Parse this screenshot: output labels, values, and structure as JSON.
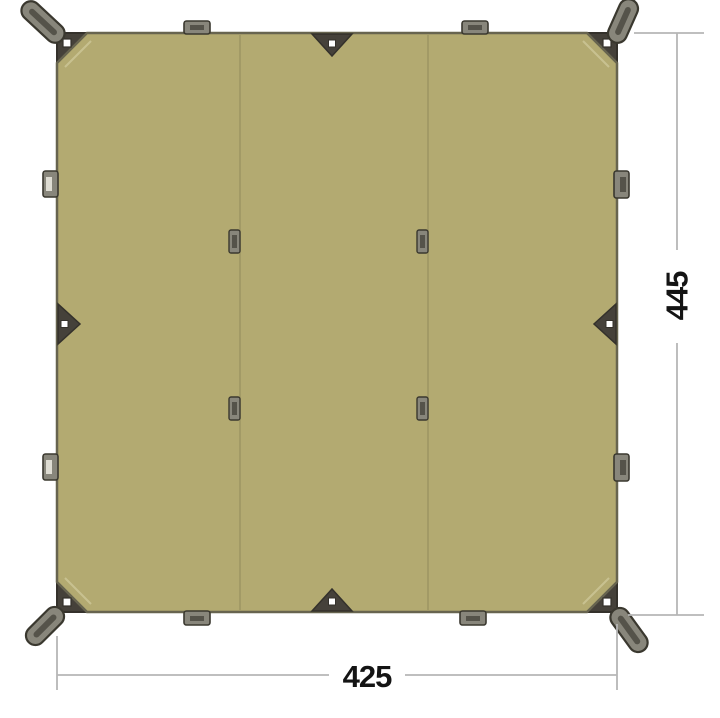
{
  "diagram": {
    "kind": "product-dimension-diagram",
    "subject": "rectangular-tarp-top-view",
    "dimension_labels": {
      "width": "425",
      "height": "445"
    },
    "features": {
      "panels": 3,
      "corner_straps": 4,
      "corner_grommets": 4,
      "edge_triangle_patches": 4,
      "edge_loops": 8,
      "seam_tabs": 4
    },
    "colors": {
      "background": "#ffffff",
      "tarp_fill": "#b3aa71",
      "tarp_edge": "#67644f",
      "seam": "#9e9663",
      "chamfer_seam": "#c8c190",
      "patch_fill": "#45413a",
      "patch_stroke": "#34312b",
      "hardware_fill": "#88867b",
      "hardware_stroke": "#3a382f",
      "slot_dark": "#55534a",
      "slot_light": "#dedcd2",
      "grommet": "#ffffff",
      "dimension_line": "#b6b6b6",
      "dimension_text": "#141414"
    }
  }
}
